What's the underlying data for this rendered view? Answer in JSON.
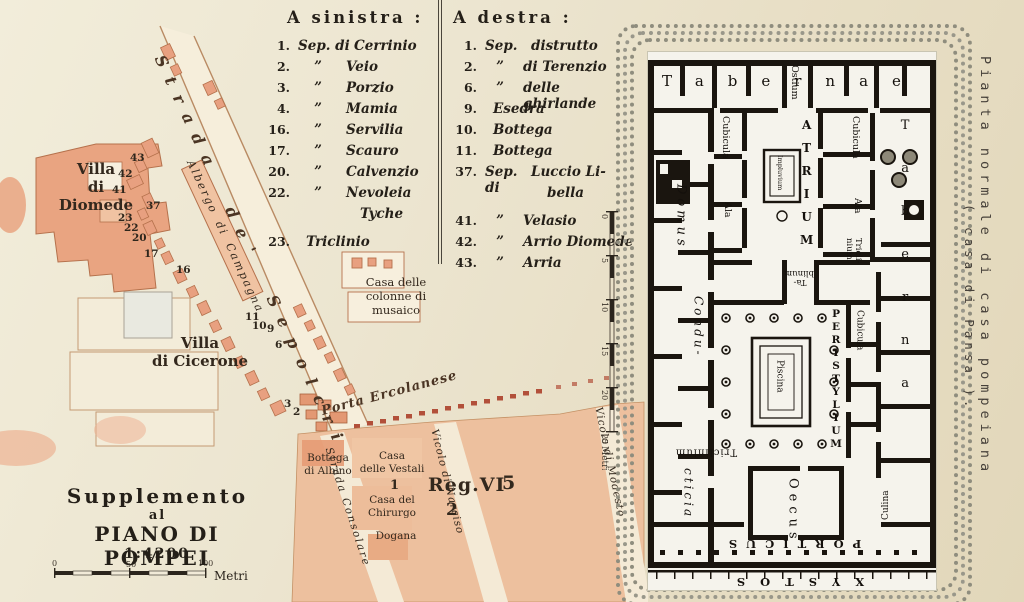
{
  "legend": {
    "left": {
      "title": "A sinistra :",
      "items": [
        {
          "num": "1.",
          "mid": "Sep. di",
          "name": "Cerrinio"
        },
        {
          "num": "2.",
          "mid": "”",
          "name": "Veio"
        },
        {
          "num": "3.",
          "mid": "”",
          "name": "Porzio"
        },
        {
          "num": "4.",
          "mid": "”",
          "name": "Mamia"
        },
        {
          "num": "16.",
          "mid": "”",
          "name": "Servilia"
        },
        {
          "num": "17.",
          "mid": "”",
          "name": "Scauro"
        },
        {
          "num": "20.",
          "mid": "”",
          "name": "Calvenzio"
        },
        {
          "num": "22.",
          "mid": "”",
          "name": "Nevoleia"
        },
        {
          "num": "",
          "mid": "",
          "name": "Tyche"
        },
        {
          "num": "23.",
          "mid": "",
          "name": "Triclinio"
        }
      ]
    },
    "right": {
      "title": "A destra :",
      "items": [
        {
          "num": "1.",
          "mid": "Sep.",
          "name": "distrutto"
        },
        {
          "num": "2.",
          "mid": "”",
          "name": "di Terenzio"
        },
        {
          "num": "6.",
          "mid": "”",
          "name": "delle ghirlande"
        },
        {
          "num": "9.",
          "mid": "",
          "name": "Esedra"
        },
        {
          "num": "10.",
          "mid": "",
          "name": "Bottega"
        },
        {
          "num": "11.",
          "mid": "",
          "name": "Bottega"
        },
        {
          "num": "37.",
          "mid": "Sep. di",
          "name": "Luccio Li-"
        },
        {
          "num": "",
          "mid": "",
          "name": "bella"
        },
        {
          "num": "41.",
          "mid": "”",
          "name": "Velasio"
        },
        {
          "num": "42.",
          "mid": "”",
          "name": "Arrio Diomede"
        },
        {
          "num": "43.",
          "mid": "”",
          "name": "Arria"
        }
      ]
    }
  },
  "map": {
    "labels": {
      "villa_diomede": "Villa\ndi\nDiomede",
      "strada_sepolcri": "Strada de' Sepolcri",
      "albergo": "Albergo di Campagna",
      "casa_colonne": "Casa delle\ncolonne di\nmusaico",
      "villa_cicerone": "Villa\ndi Cicerone",
      "porta_ercolanese": "Porta Ercolanese",
      "bottega_albino": "Bottega\ndi Albino",
      "casa_vestali": "Casa\ndelle Vestali",
      "vestali_number": "1",
      "casa_chirurgo": "Casa del\nChirurgo",
      "dogana": "Dogana",
      "strada_consolare": "Strada Consolare",
      "vicolo_narciso": "Vicolo di Narciso",
      "vicolo_modesto": "Vicolo di Modesto",
      "reg_vi": "Reg.VI",
      "reg_vi_5": "5",
      "reg_vi_2": "2"
    },
    "street_numbers": [
      "43",
      "42",
      "41",
      "37",
      "23",
      "22",
      "20",
      "17",
      "16",
      "11",
      "10",
      "9",
      "6",
      "3",
      "2"
    ],
    "title": {
      "line1": "Supplemento",
      "line2": "al",
      "line3": "PIANO DI POMPEI",
      "scale": "1:4200"
    },
    "scalebar": {
      "t0": "0",
      "t1": "50",
      "t2": "100",
      "unit": "Metri"
    }
  },
  "plan": {
    "caption": {
      "line1": "Pianta normale di casa pompeiana",
      "line2": "( casa di Pansa )."
    },
    "labels": {
      "tabernae_top": "Tabernae",
      "taberna_right": "Taberna",
      "ostium": "Ostium",
      "atrium": "ATRIUM",
      "impluvium": "Impluvium",
      "cubicula_left": "Cubicula",
      "ala_left": "Ala",
      "cubicula_atrium_right": "Cubicula",
      "ala_right": "Ala",
      "triclinium_right": "Tricli-\nnium",
      "tablinum": "Ta-\nblinum",
      "domus": "Domus",
      "condu": "Condu-",
      "cticia": "cticia",
      "peristylium": "PERISTYLIUM",
      "piscina": "Piscina",
      "cubicula_peristyle": "Cubicula",
      "triclinium_bottom": "Triclinium",
      "oecus": "Oecus",
      "culina": "Culina",
      "porticus": "PORTICUS",
      "xystos": "XYSTOS"
    },
    "left_scale": {
      "ticks": [
        "0",
        "5",
        "10",
        "15",
        "20",
        "25"
      ],
      "unit": "Metri"
    }
  },
  "colors": {
    "paper": "#ece5d0",
    "salmon": "#e9a481",
    "salmon_light": "#edc09e",
    "outline": "#b5714c",
    "city_wall_red": "#b2503a",
    "ink": "#241f18",
    "plan_wall": "#1a150f"
  }
}
